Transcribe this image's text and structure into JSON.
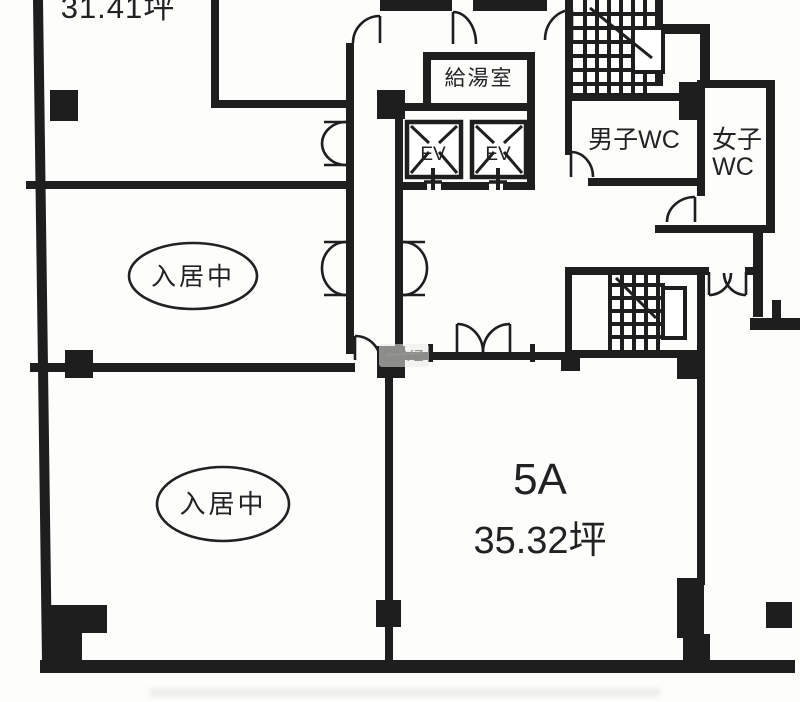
{
  "floorplan": {
    "top_left_unit": {
      "area_label": "31.41坪"
    },
    "kitchenette_label": "給湯室",
    "elevators": {
      "ev1_label": "EV",
      "ev2_label": "EV"
    },
    "mens_wc_label": "男子WC",
    "womens_wc": {
      "line1": "女子",
      "line2": "WC"
    },
    "occupied_room_1_label": "入居中",
    "occupied_room_2_label": "入居中",
    "unit_5a": {
      "name": "5A",
      "area_label": "35.32坪"
    },
    "watermark": "ReYZ",
    "colors": {
      "wall": "#1e1e1e",
      "background": "#fdfdfc",
      "watermark_text": "#8b8b85"
    }
  }
}
